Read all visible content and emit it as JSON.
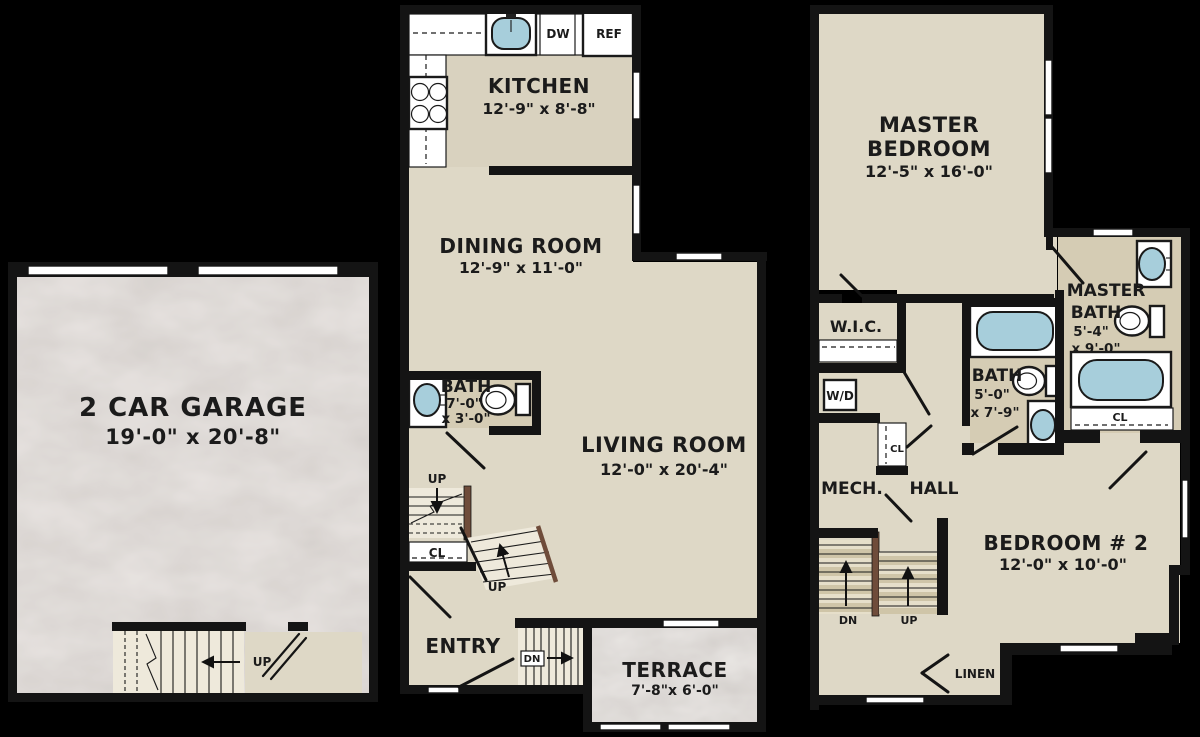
{
  "floorplan": {
    "background_color": "#000000",
    "wall_color": "#141414",
    "floor_color": "#ded8c6",
    "bath_floor_color": "#d5ccb4",
    "garage_floor_color": "#cbc5c1",
    "terrace_floor_color": "#c7c1bd",
    "fixture_blue": "#a7cedb",
    "rail_color": "#6f4c3a",
    "garage": {
      "name": "2 CAR GARAGE",
      "dims": "19'-0\" x 20'-8\"",
      "stair_label": "UP"
    },
    "first_floor": {
      "kitchen": {
        "name": "KITCHEN",
        "dims": "12'-9\" x 8'-8\"",
        "dishwasher": "DW",
        "refrigerator": "REF"
      },
      "dining_room": {
        "name": "DINING ROOM",
        "dims": "12'-9\" x 11'-0\""
      },
      "bath": {
        "name": "BATH",
        "dims_line1": "7'-0\"",
        "dims_line2": "x 3'-0\""
      },
      "living_room": {
        "name": "LIVING ROOM",
        "dims": "12'-0\" x 20'-4\""
      },
      "entry": {
        "name": "ENTRY"
      },
      "terrace": {
        "name": "TERRACE",
        "dims": "7'-8\"x 6'-0\""
      },
      "stair_up_label": "UP",
      "winder_up_label": "UP",
      "stair_dn_label": "DN",
      "closet_label": "CL"
    },
    "second_floor": {
      "master_bedroom": {
        "name_line1": "MASTER",
        "name_line2": "BEDROOM",
        "dims": "12'-5\" x 16'-0\""
      },
      "wic": {
        "name": "W.I.C."
      },
      "washer_dryer": "W/D",
      "mech": {
        "name": "MECH."
      },
      "hall": {
        "name": "HALL"
      },
      "hall_closet_label": "CL",
      "master_bath": {
        "name_line1": "MASTER",
        "name_line2": "BATH",
        "dims_line1": "5'-4\"",
        "dims_line2": "x 9'-0\""
      },
      "bath": {
        "name": "BATH",
        "dims_line1": "5'-0\"",
        "dims_line2": "x 7'-9\""
      },
      "bedroom2": {
        "name": "BEDROOM # 2",
        "dims": "12'-0\" x 10'-0\""
      },
      "bedroom2_closet_label": "CL",
      "linen": {
        "name": "LINEN"
      },
      "stair_dn_label": "DN",
      "stair_up_label": "UP"
    }
  }
}
